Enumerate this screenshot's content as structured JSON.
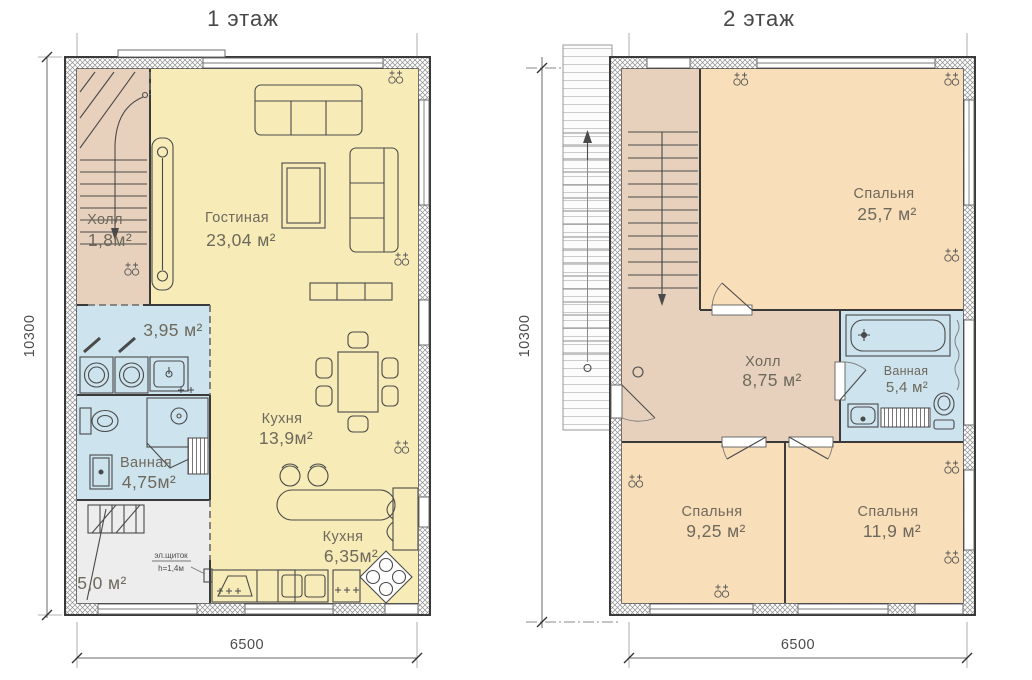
{
  "drawing": {
    "floor1": {
      "title": "1 этаж",
      "dimensions": {
        "height": "10300",
        "width": "6500"
      },
      "rooms": {
        "hall": {
          "name": "Холл",
          "area": "1,8м²"
        },
        "living": {
          "name": "Гостиная",
          "area": "23,04 м²"
        },
        "laundry": {
          "area": "3,95 м²"
        },
        "bathroom": {
          "name": "Ванная",
          "area": "4,75м²"
        },
        "kitchen": {
          "name": "Кухня",
          "area": "13,9м²"
        },
        "kitchen2": {
          "name": "Кухня",
          "area": "6,35м²"
        },
        "storage": {
          "area": "5,0 м²"
        }
      },
      "notes": {
        "electrical_panel": "эл.щиток",
        "panel_height": "h=1,4м"
      }
    },
    "floor2": {
      "title": "2 этаж",
      "dimensions": {
        "height": "10300",
        "width": "6500"
      },
      "rooms": {
        "bedroom1": {
          "name": "Спальня",
          "area": "25,7 м²"
        },
        "hall": {
          "name": "Холл",
          "area": "8,75 м²"
        },
        "bathroom": {
          "name": "Ванная",
          "area": "5,4 м²"
        },
        "bedroom2": {
          "name": "Спальня",
          "area": "9,25 м²"
        },
        "bedroom3": {
          "name": "Спальня",
          "area": "11,9 м²"
        }
      }
    }
  },
  "colors": {
    "living_yellow": "#F7ECB8",
    "hall_tan": "#E7D1BC",
    "bathroom_blue": "#CDE3ED",
    "bedroom_peach": "#F8DEB9",
    "storage_gray": "#EDEDED",
    "wall_line": "#3A3A3A",
    "label_text": "#6E695D"
  }
}
